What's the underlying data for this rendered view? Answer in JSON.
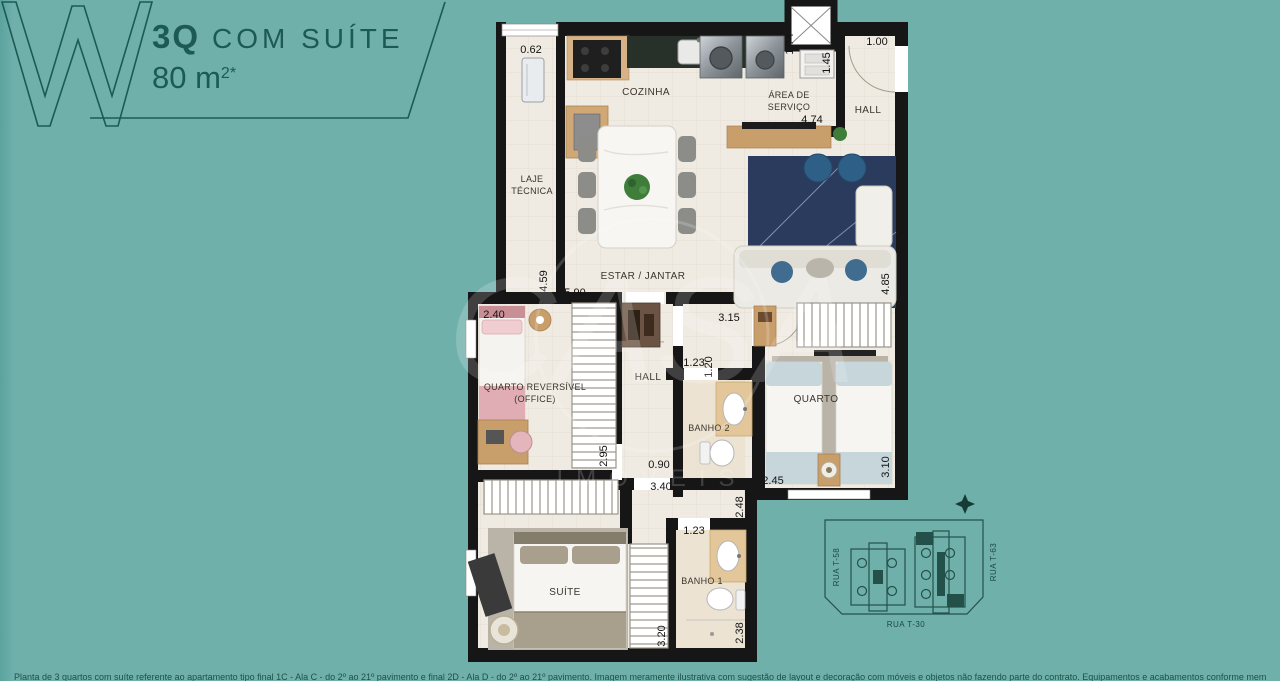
{
  "header": {
    "type_label": "3Q",
    "suffix_label": "COM SUÍTE",
    "area_value": "80 m",
    "area_exp": "2*"
  },
  "colors": {
    "background": "#6FB0AB",
    "accent": "#1E5A54",
    "wall": "#161616",
    "floor": "#F0EBE2"
  },
  "plan": {
    "rooms": {
      "cozinha": "COZINHA",
      "area_servico_1": "ÁREA DE",
      "area_servico_2": "SERVIÇO",
      "hall_entrada": "HALL",
      "laje_1": "LAJE",
      "laje_2": "TÉCNICA",
      "estar": "ESTAR / JANTAR",
      "quarto_rev_1": "QUARTO REVERSÍVEL",
      "quarto_rev_2": "(OFFICE)",
      "hall": "HALL",
      "banho2": "BANHO 2",
      "quarto": "QUARTO",
      "suite": "SUÍTE",
      "banho1": "BANHO 1"
    },
    "dims": {
      "laje_top": "0.62",
      "as_d1": "1.74",
      "as_d2": "1.45",
      "entry": "1.00",
      "as_w": "4.74",
      "laje_h": "4.59",
      "estar_w": "5.90",
      "estar_h": "4.85",
      "qrev_w": "2.40",
      "vest_w": "3.15",
      "hall_d": "1.20",
      "banho2_w": "1.23",
      "qrev_h": "2.95",
      "hall_w": "0.90",
      "hall_total": "3.40",
      "quarto_w": "2.45",
      "quarto_h": "3.10",
      "corr_h": "2.48",
      "banho1_w": "1.23",
      "banho1_h": "2.38",
      "suite_h": "3.20"
    }
  },
  "site_map": {
    "street_left": "RUA T-58",
    "street_right": "RUA T-63",
    "street_bottom": "RUA T-30"
  },
  "watermark": {
    "text": "CASA",
    "subtext": "IMÓVEIS"
  },
  "footer": {
    "disclaimer": "Planta de 3 quartos com suíte referente ao apartamento tipo final 1C - Ala C - do 2º ao 21º pavimento e final 2D - Ala D - do 2º ao 21º pavimento. Imagem meramente ilustrativa com sugestão de layout e decoração com móveis e objetos não fazendo parte do contrato. Equipamentos e acabamentos conforme memorial descritivo."
  }
}
